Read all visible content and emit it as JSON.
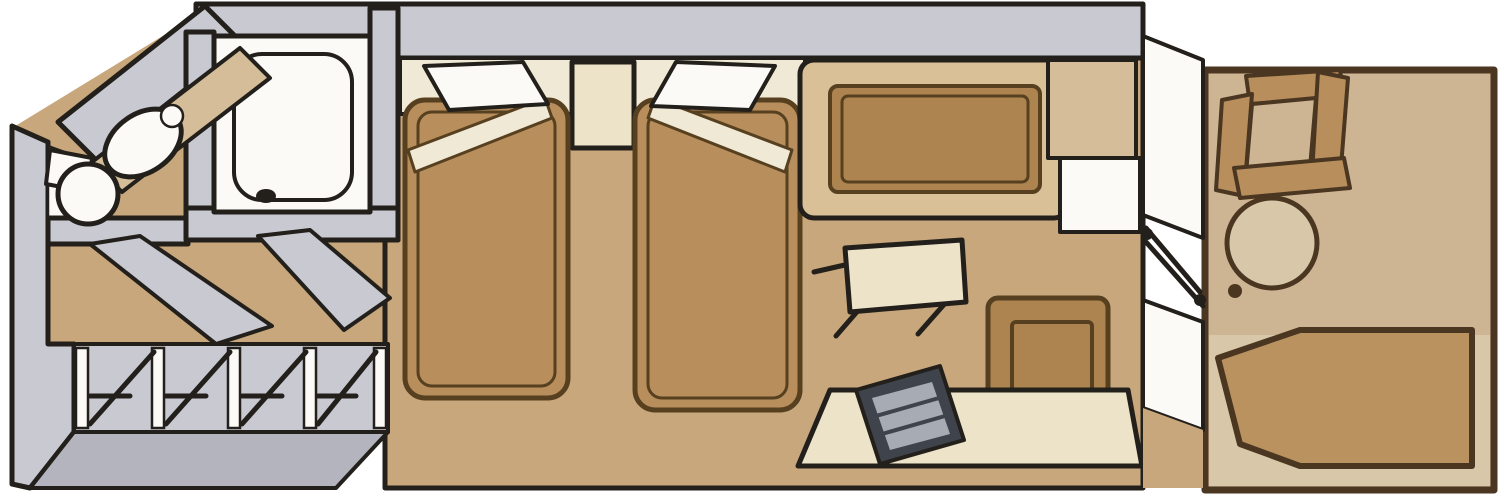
{
  "diagram": {
    "type": "floor-plan",
    "subject": "cruise-ship stateroom with private balcony, axonometric sketch",
    "rooms": [
      {
        "name": "bathroom",
        "contents": [
          "bathtub",
          "sink",
          "toilet"
        ]
      },
      {
        "name": "entry-corridor",
        "contents": [
          "door-swings",
          "closet-row"
        ]
      },
      {
        "name": "main-cabin",
        "contents": [
          "twin-bed-1",
          "twin-bed-2",
          "nightstand",
          "sofa",
          "coffee-table",
          "ottoman",
          "cabinet",
          "desk",
          "tv",
          "sliding-glass-door"
        ]
      },
      {
        "name": "balcony",
        "contents": [
          "balcony-chair",
          "balcony-table",
          "lounge-chair"
        ]
      }
    ],
    "furniture_count": 15
  },
  "colors": {
    "background": "#ffffff",
    "wall_gray": "#c9c9d2",
    "wall_dark": "#b4b4bf",
    "outline": "#23201c",
    "dark_brown": "#4a3621",
    "floor_tan": "#c8a77c",
    "floor_light": "#d4bd98",
    "cream": "#ede3c9",
    "cream_light": "#f0e9d6",
    "white_fixture": "#fbfaf6",
    "bed_brown": "#b78e5c",
    "bed_outline": "#57401f",
    "sofa_brown": "#ad8450",
    "sofa_rim": "#d9c096",
    "balcony_tan": "#cdb492",
    "balcony_light": "#d8c7a8",
    "lounger_brown": "#b9925f",
    "tv_dark": "#3f444c",
    "tv_gray": "#a6abb4"
  }
}
